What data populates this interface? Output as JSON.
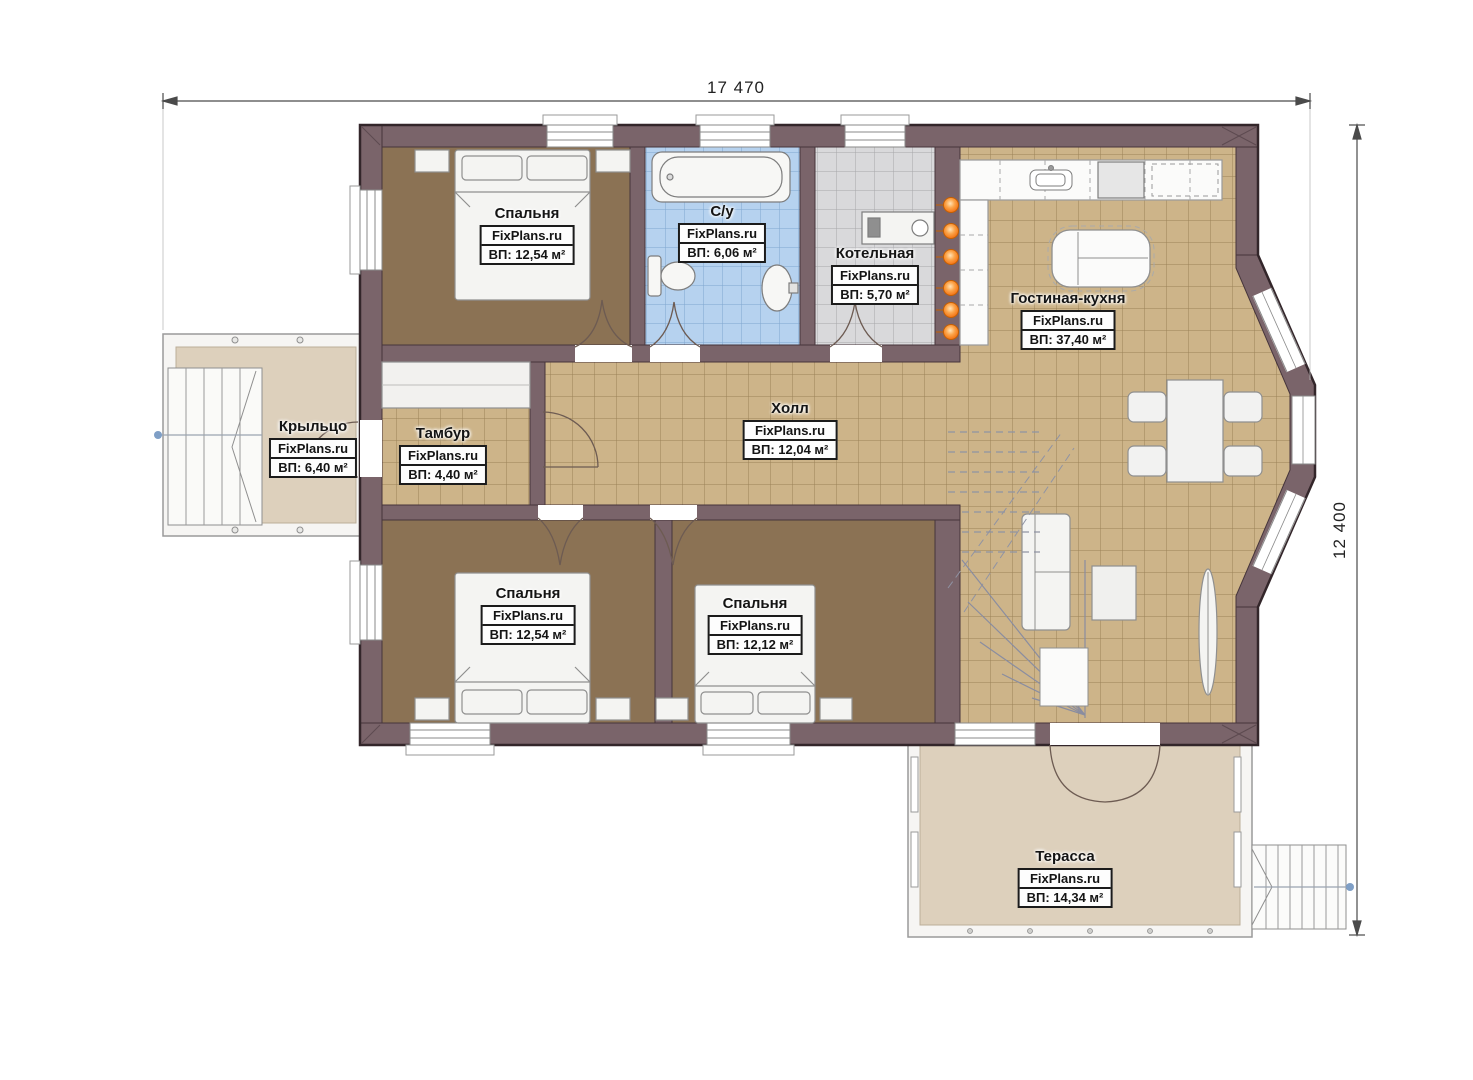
{
  "plan": {
    "type": "floor-plan",
    "brand_watermark": "FixPlans.ru"
  },
  "dimensions": {
    "width_label": "17 470",
    "height_label": "12 400"
  },
  "rooms": [
    {
      "id": "bedroom-1",
      "name": "Спальня",
      "brand": "FixPlans.ru",
      "area": "ВП: 12,54 м²"
    },
    {
      "id": "bathroom",
      "name": "С/у",
      "brand": "FixPlans.ru",
      "area": "ВП: 6,06 м²"
    },
    {
      "id": "boiler-room",
      "name": "Котельная",
      "brand": "FixPlans.ru",
      "area": "ВП: 5,70 м²"
    },
    {
      "id": "living-kitchen",
      "name": "Гостиная-кухня",
      "brand": "FixPlans.ru",
      "area": "ВП: 37,40 м²"
    },
    {
      "id": "porch",
      "name": "Крыльцо",
      "brand": "FixPlans.ru",
      "area": "ВП: 6,40 м²"
    },
    {
      "id": "vestibule",
      "name": "Тамбур",
      "brand": "FixPlans.ru",
      "area": "ВП: 4,40 м²"
    },
    {
      "id": "hall",
      "name": "Холл",
      "brand": "FixPlans.ru",
      "area": "ВП: 12,04 м²"
    },
    {
      "id": "bedroom-2",
      "name": "Спальня",
      "brand": "FixPlans.ru",
      "area": "ВП: 12,54 м²"
    },
    {
      "id": "bedroom-3",
      "name": "Спальня",
      "brand": "FixPlans.ru",
      "area": "ВП: 12,12 м²"
    },
    {
      "id": "terrace",
      "name": "Терасса",
      "brand": "FixPlans.ru",
      "area": "ВП: 14,34 м²"
    }
  ],
  "colors": {
    "wall": "#7a646a",
    "wall_outline": "#33262a",
    "bedroom_floor": "#8b7254",
    "tile_tan": "#cdb489",
    "tile_blue": "#b6d2ef",
    "tile_gray": "#d9d9db",
    "deck_beige": "#ddd0bc",
    "furniture": "#f4f4f2",
    "radiator_orange": "#f97b16",
    "stair_arrow_blue": "#7f9fc6"
  }
}
